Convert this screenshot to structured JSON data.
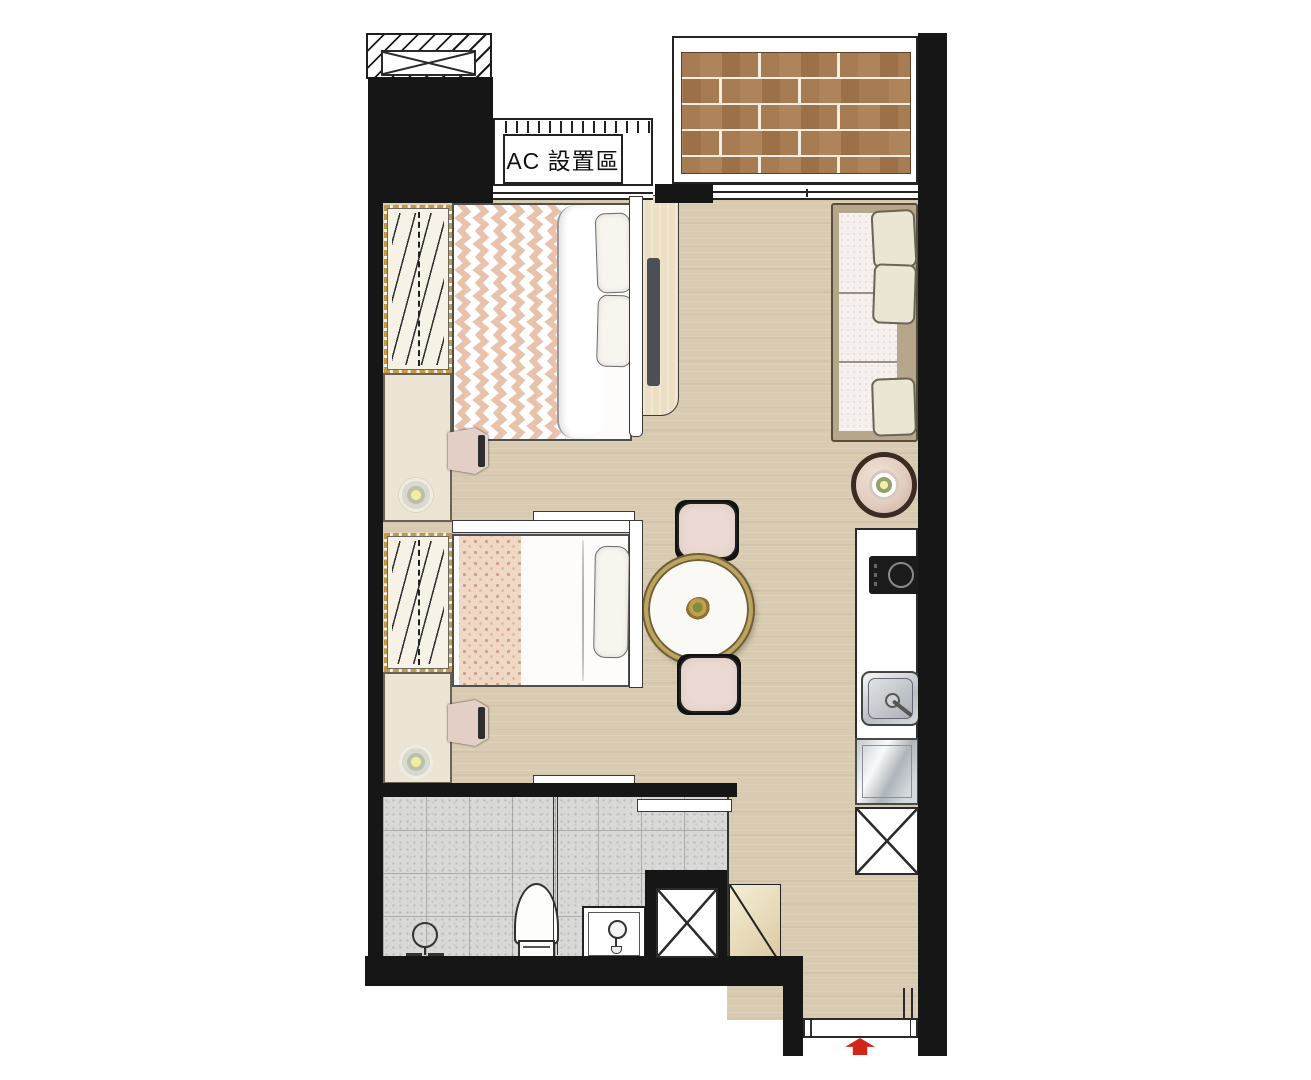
{
  "plan": {
    "type": "studio-apartment-floor-plan",
    "labels": {
      "ac_area": "AC 設置區"
    },
    "rooms": [
      "bedroom-area",
      "living-dining-area",
      "kitchenette",
      "bathroom",
      "balcony-deck",
      "entry"
    ],
    "furniture": [
      "wardrobe-1",
      "bed-1",
      "tv-console-1",
      "desk-1",
      "chair-1",
      "desk-lamp-1",
      "wardrobe-2",
      "bed-2",
      "desk-2",
      "chair-2",
      "desk-lamp-2",
      "dining-table",
      "dining-chair-top",
      "dining-chair-bottom",
      "sofa",
      "side-table",
      "kitchen-counter",
      "cooktop",
      "kitchen-sink",
      "fridge",
      "x-cabinet",
      "shower-set",
      "glass-partition",
      "toilet",
      "vanity-sink",
      "entry-cabinet",
      "entry-door"
    ],
    "entry_marker": "red-arrow-pointing-in"
  },
  "colors": {
    "wall": "#161616",
    "floor": "#d8cbb1",
    "deck": "#a87c52",
    "deck_gap": "#f2eee4",
    "tile": "#d9d9d7",
    "accent_red": "#d3261a",
    "wardrobe_dash": "#c49a45",
    "desk_cream": "#ece5d5",
    "console_wood": "#ecdfc3",
    "tv_dark": "#4a5055",
    "sofa_frame": "#b6a78c",
    "pattern_pink": "#f0d8c7",
    "blanket_pink": "#e9c2ac",
    "chair_pink": "#ecd9d3",
    "table_gold": "#bda45e",
    "side_table_rim": "#3c2b23",
    "side_table_fill": "#e2cdc0"
  }
}
